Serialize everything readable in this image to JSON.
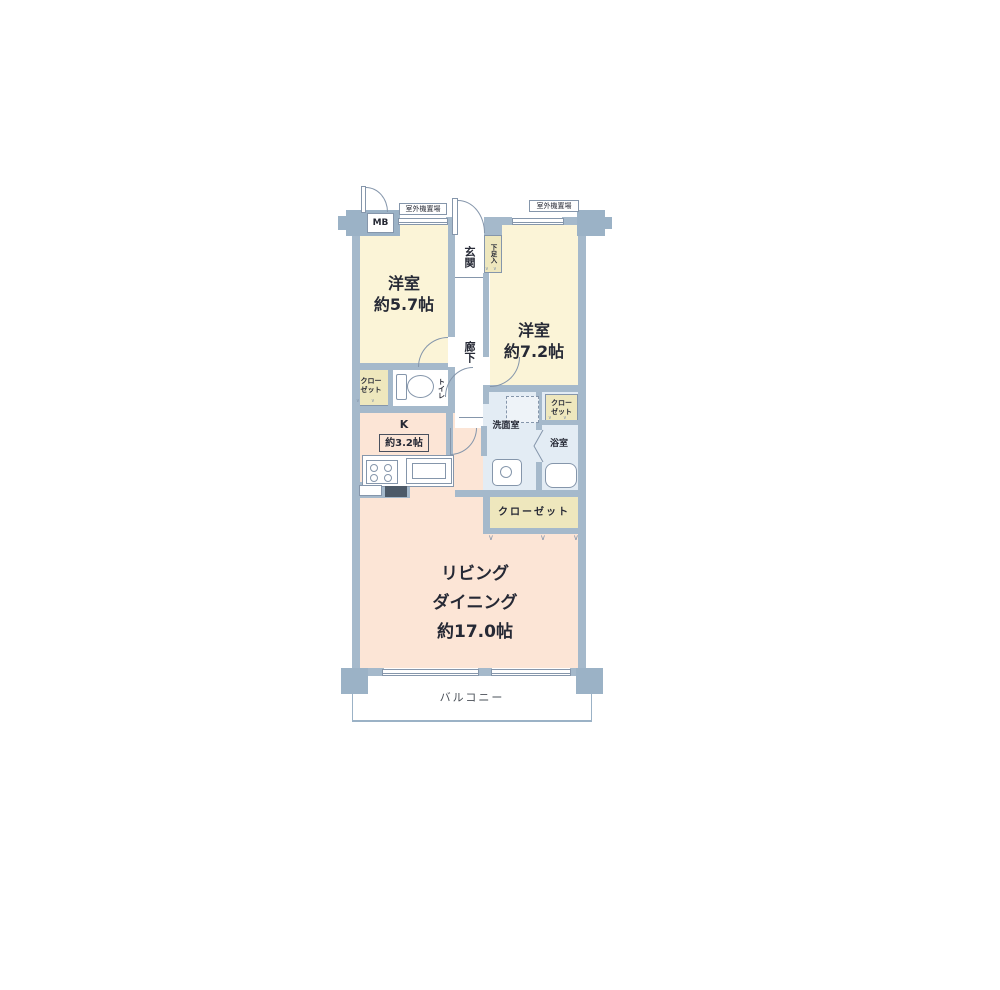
{
  "palette": {
    "wall": "#a5b9cb",
    "pillar": "#9bb2c6",
    "bedroom_fill": "#fbf4d7",
    "closet_fill": "#eee7bd",
    "living_fill": "#fce5d6",
    "wet_fill": "#e3ecf4",
    "outline": "#8596ab",
    "text": "#262935"
  },
  "plan": {
    "mb": "MB",
    "outdoor_unit": "室外機置場",
    "entrance": "玄関",
    "shoe_box": "下足入",
    "hallway": "廊下",
    "toilet": "トイレ",
    "washroom": "洗面室",
    "bathroom": "浴室",
    "kitchen": {
      "name": "K",
      "size": "約3.2帖"
    },
    "bedroom1": {
      "name": "洋室",
      "size": "約5.7帖"
    },
    "bedroom2": {
      "name": "洋室",
      "size": "約7.2帖"
    },
    "living": {
      "line1": "リビング",
      "line2": "ダイニング",
      "line3": "約17.0帖"
    },
    "closet_small": {
      "line1": "クロー",
      "line2": "ゼット"
    },
    "closet_wide": "クローゼット",
    "balcony": "バルコニー",
    "fold_mark": "∨"
  }
}
